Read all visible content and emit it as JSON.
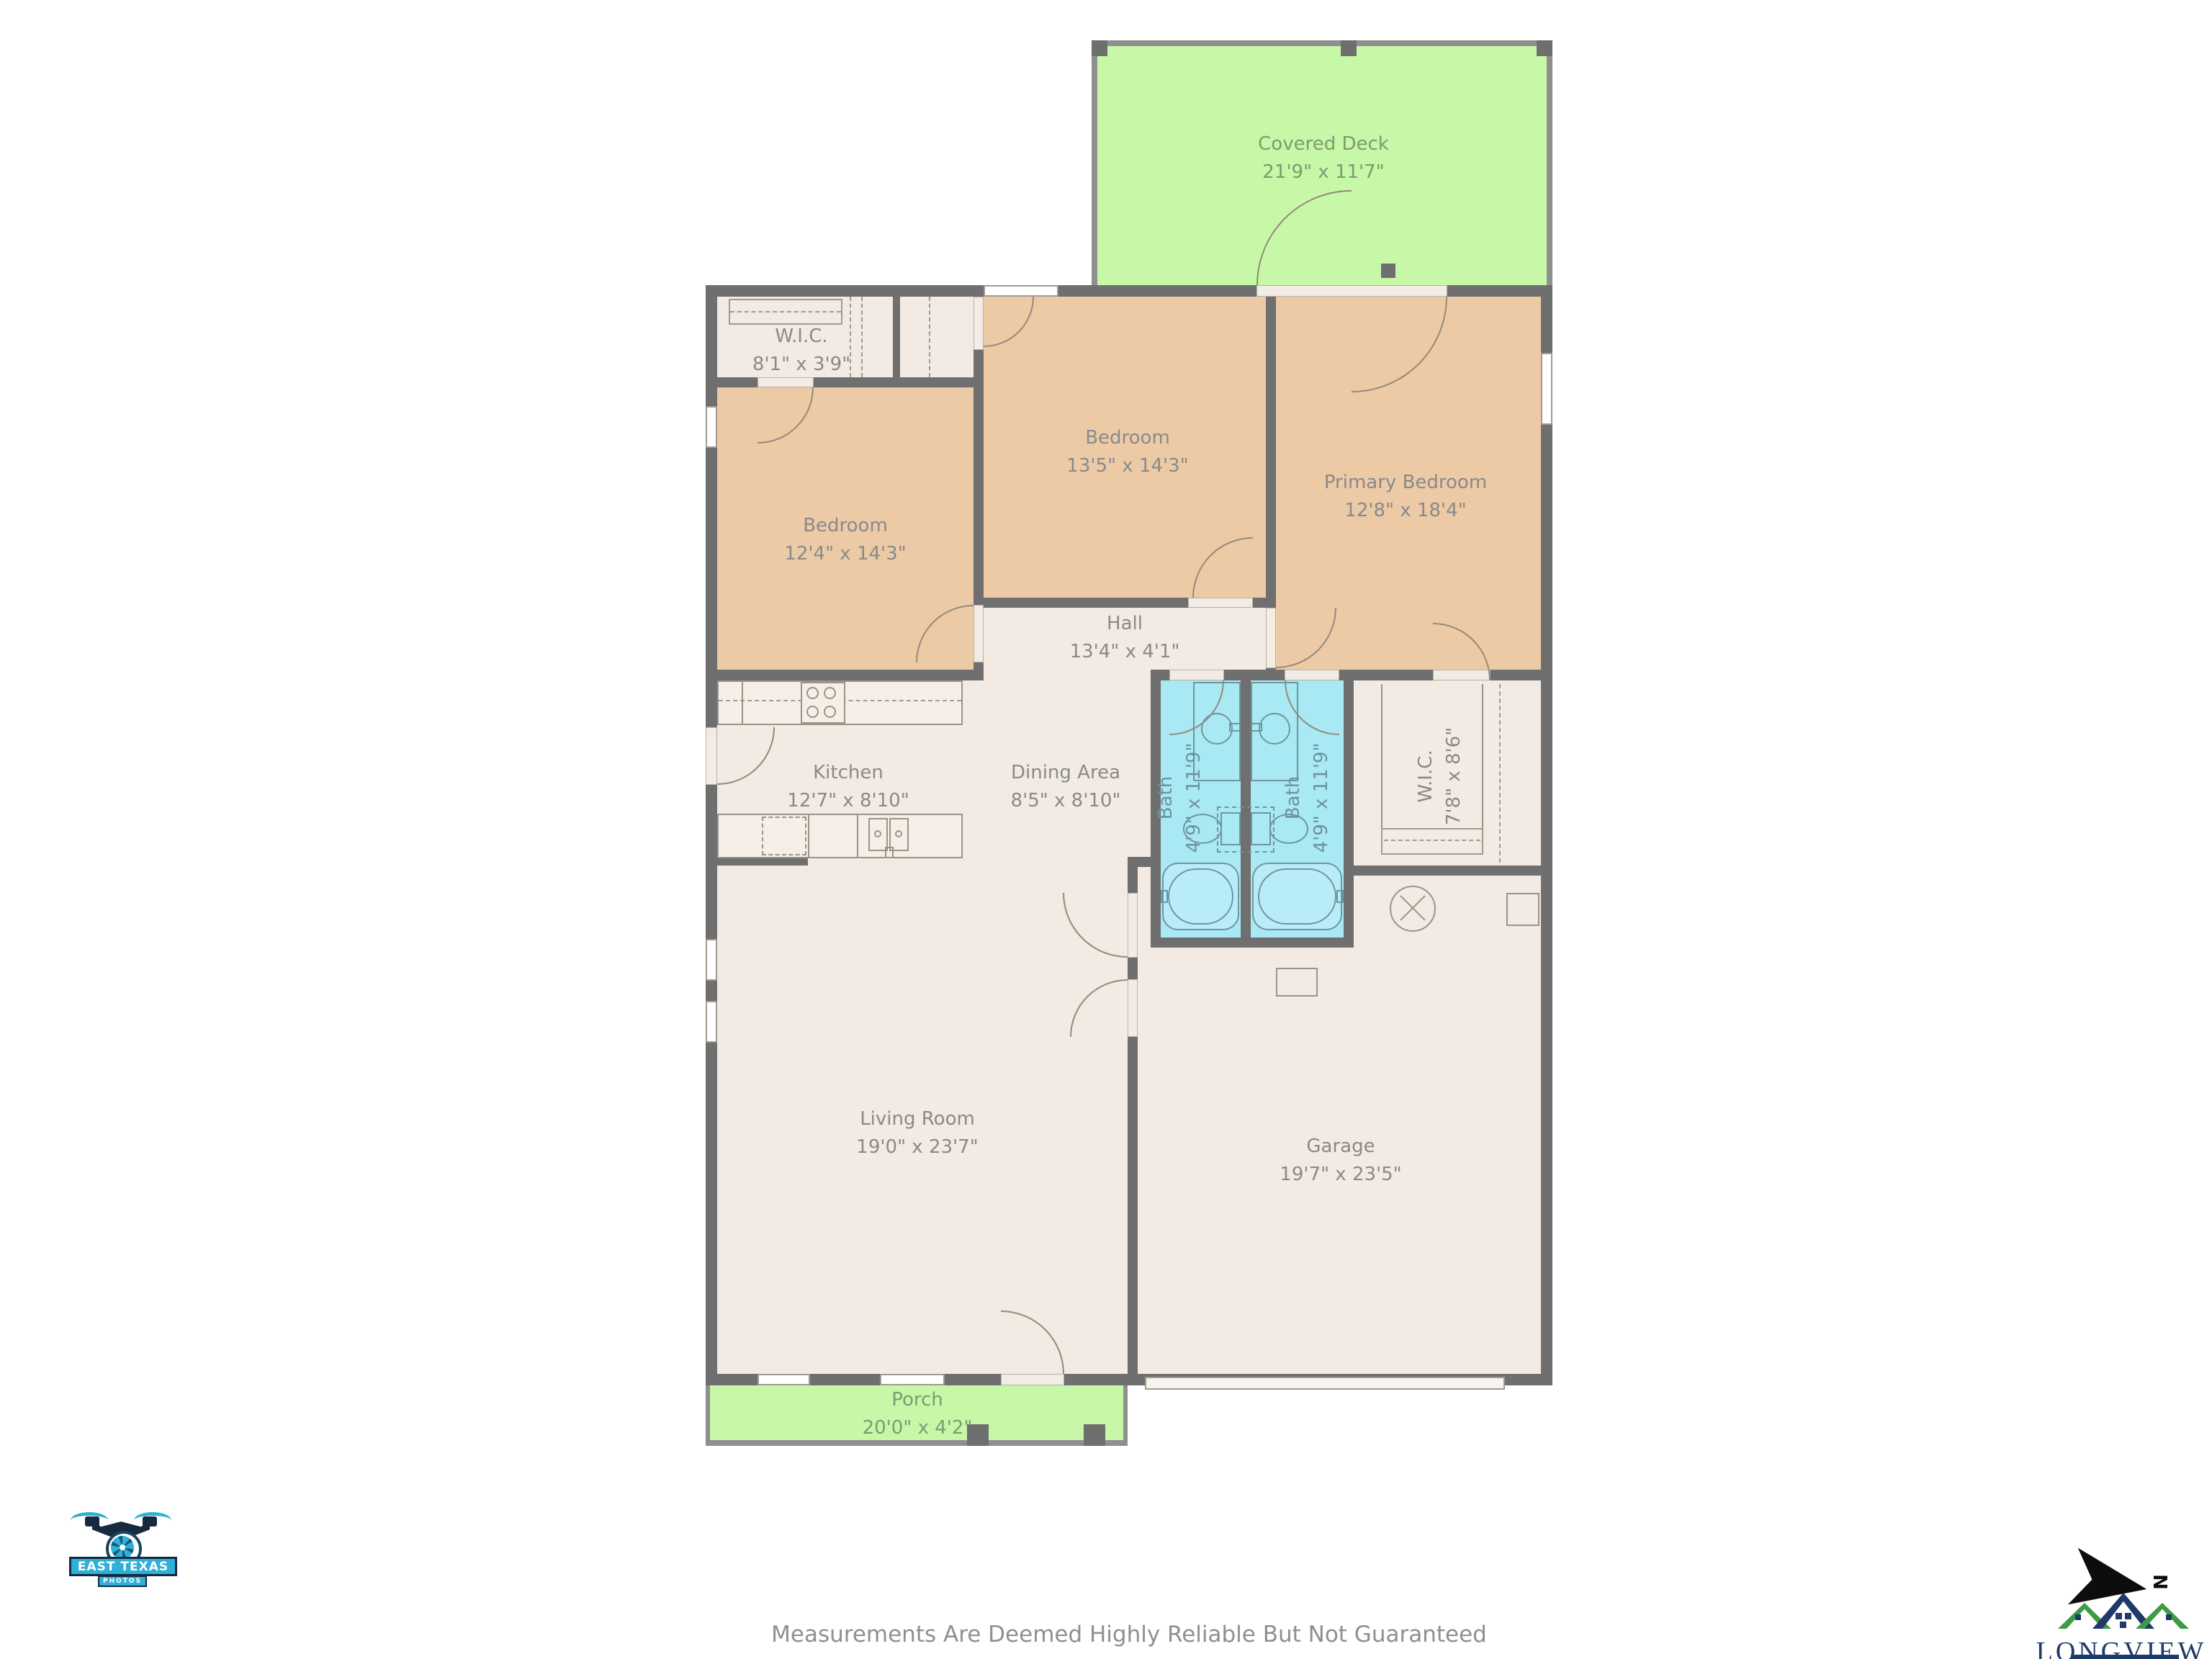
{
  "rooms": {
    "covered_deck": {
      "name": "Covered Deck",
      "dims": "21'9\" x 11'7\""
    },
    "wic_top": {
      "name": "W.I.C.",
      "dims": "8'1\" x 3'9\""
    },
    "bedroom_mid": {
      "name": "Bedroom",
      "dims": "13'5\" x 14'3\""
    },
    "primary_bedroom": {
      "name": "Primary Bedroom",
      "dims": "12'8\" x 18'4\""
    },
    "bedroom_left": {
      "name": "Bedroom",
      "dims": "12'4\" x 14'3\""
    },
    "hall": {
      "name": "Hall",
      "dims": "13'4\" x 4'1\""
    },
    "kitchen": {
      "name": "Kitchen",
      "dims": "12'7\" x 8'10\""
    },
    "dining": {
      "name": "Dining Area",
      "dims": "8'5\" x 8'10\""
    },
    "bath_left": {
      "name": "Bath",
      "dims": "4'9\" x 11'9\""
    },
    "bath_right": {
      "name": "Bath",
      "dims": "4'9\" x 11'9\""
    },
    "wic_right": {
      "name": "W.I.C.",
      "dims": "7'8\" x 8'6\""
    },
    "living": {
      "name": "Living Room",
      "dims": "19'0\" x 23'7\""
    },
    "garage": {
      "name": "Garage",
      "dims": "19'7\" x 23'5\""
    },
    "porch": {
      "name": "Porch",
      "dims": "20'0\" x 4'2\""
    }
  },
  "footer": {
    "disclaimer": "Measurements Are Deemed Highly Reliable But Not Guaranteed"
  },
  "logos": {
    "photographer": {
      "line1": "EAST TEXAS",
      "line2": "PHOTOS"
    },
    "realtor": {
      "name": "LONGVIEW",
      "subtitle": "AREA ASSOCIATION OF REALTORS®",
      "north_label": "N"
    }
  },
  "colors": {
    "wall": "#6f6f6f",
    "bedroom_fill": "#eccaa6",
    "floor_fill": "#f2eae3",
    "bath_fill": "#a9e9f4",
    "outdoor_fill": "#c6f8a7",
    "label_text": "#8a8a8a",
    "logo_teal": "#2fb0d6",
    "logo_navy": "#1f3a68"
  }
}
